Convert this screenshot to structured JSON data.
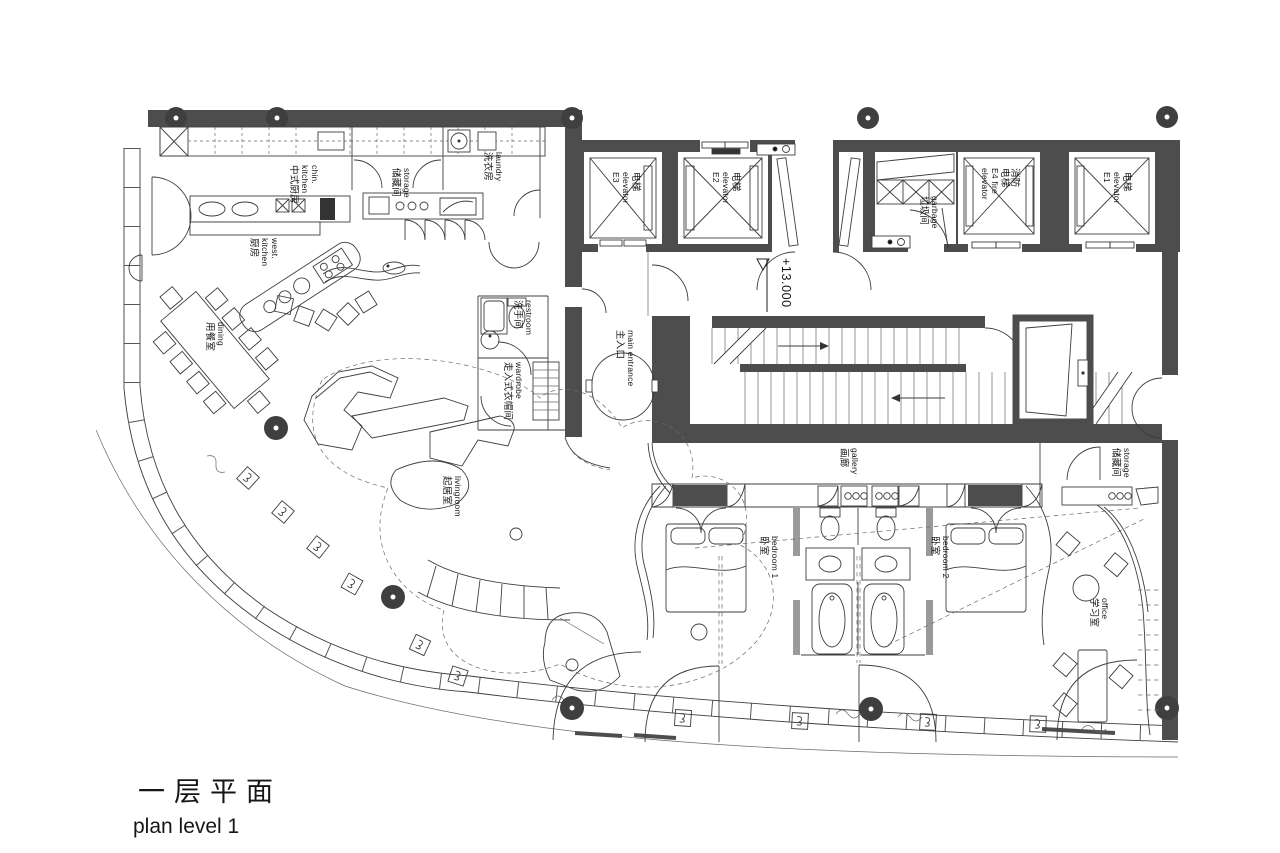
{
  "title": {
    "zh": "一层平面",
    "en": "plan level 1"
  },
  "level_marker": "+13.000",
  "rooms": {
    "chin_kitchen": {
      "en1": "chin.",
      "en2": "kitchen",
      "zh": "中式厨房"
    },
    "storage_top": {
      "en": "storage",
      "zh": "储藏间"
    },
    "laundry": {
      "en": "laundry",
      "zh": "洗衣房"
    },
    "west_kitchen": {
      "en1": "west.",
      "en2": "kitchen",
      "zh": "厨房"
    },
    "dining": {
      "en": "dining",
      "zh": "用餐室"
    },
    "restroom": {
      "en": "restroom",
      "zh": "洗手间"
    },
    "wardrobe": {
      "en": "wardrobe",
      "zh": "走入式衣帽间"
    },
    "main_entrance": {
      "en": "main entrance",
      "zh": "主入口"
    },
    "elevator_e3": {
      "zh": "电梯",
      "en": "elevator",
      "id": "E3"
    },
    "elevator_e2": {
      "zh": "电梯",
      "en": "elevator",
      "id": "E2"
    },
    "garbage": {
      "en": "garbage",
      "zh": "垃圾间"
    },
    "fire_elevator_e4": {
      "zh1": "消防",
      "zh2": "电梯",
      "en1": "E4 fire",
      "en2": "elevator"
    },
    "elevator_e1": {
      "zh": "电梯",
      "en": "elevator",
      "id": "E1"
    },
    "gallery": {
      "en": "gallery",
      "zh": "画廊"
    },
    "storage_right": {
      "en": "storage",
      "zh": "储藏间"
    },
    "livingroom": {
      "en": "livingroom",
      "zh": "起居室"
    },
    "bedroom1": {
      "en": "bedroom 1",
      "zh": "卧室"
    },
    "bedroom2": {
      "en": "bedroom 2",
      "zh": "卧室"
    },
    "office": {
      "en": "office",
      "zh": "学习室"
    }
  }
}
